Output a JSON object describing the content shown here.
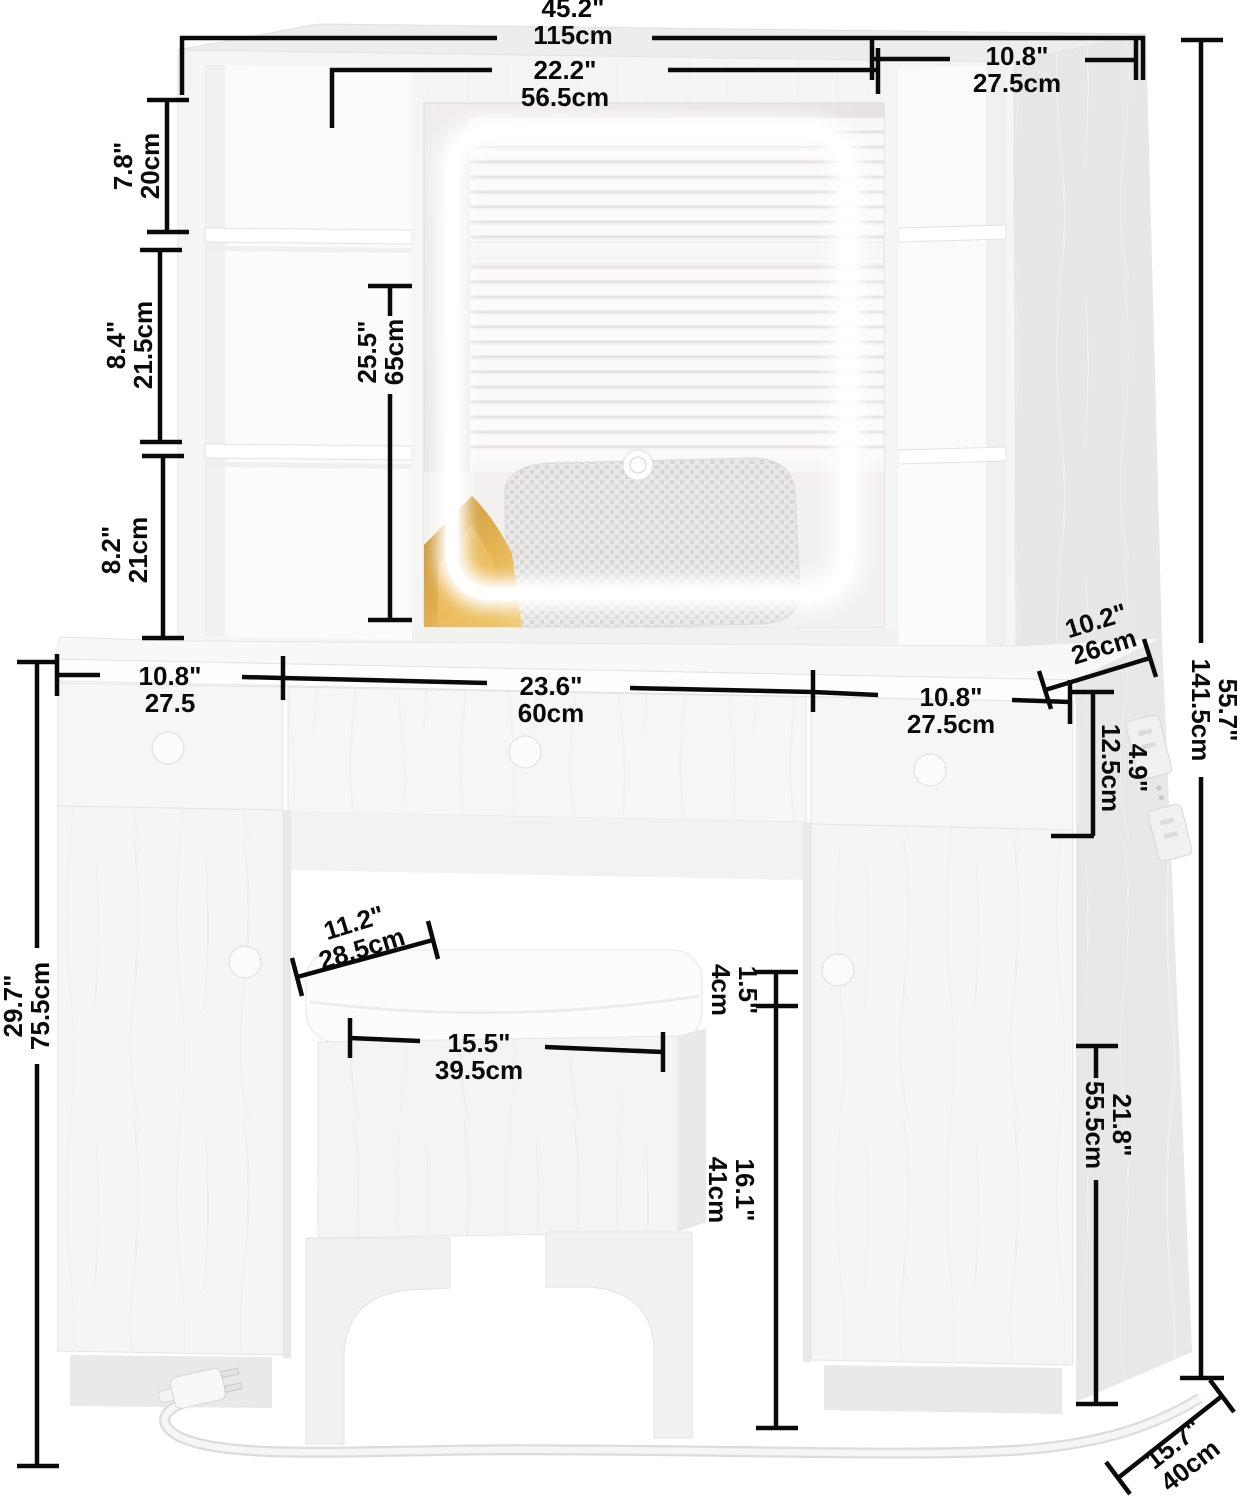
{
  "meta": {
    "type": "furniture-dimension-diagram",
    "subject": "vanity desk with LED mirror hutch and storage stool"
  },
  "colors": {
    "background": "#ffffff",
    "dimension_line": "#0a0a0a",
    "wood_front": "#f6f6f4",
    "wood_side": "#e8e8e6",
    "led_glow": "#ffffff",
    "gold_fabric": "#d9a43e"
  },
  "dimensions": {
    "overall_width": {
      "in": "45.2\"",
      "cm": "115cm"
    },
    "mirror_width": {
      "in": "22.2\"",
      "cm": "56.5cm"
    },
    "right_shelf_width": {
      "in": "10.8\"",
      "cm": "27.5cm"
    },
    "left_shelf_top": {
      "in": "7.8\"",
      "cm": "20cm"
    },
    "left_shelf_mid": {
      "in": "8.4\"",
      "cm": "21.5cm"
    },
    "left_shelf_bottom": {
      "in": "8.2\"",
      "cm": "21cm"
    },
    "mirror_height": {
      "in": "25.5\"",
      "cm": "65cm"
    },
    "hutch_depth": {
      "in": "10.2\"",
      "cm": "26cm"
    },
    "total_height": {
      "in": "55.7\"",
      "cm": "141.5cm"
    },
    "left_drawer_width": {
      "in": "10.8\"",
      "cm": "27.5"
    },
    "middle_drawer_width": {
      "in": "23.6\"",
      "cm": "60cm"
    },
    "right_drawer_width": {
      "in": "10.8\"",
      "cm": "27.5cm"
    },
    "drawer_height": {
      "in": "4.9\"",
      "cm": "12.5cm"
    },
    "desk_height": {
      "in": "29.7\"",
      "cm": "75.5cm"
    },
    "stool_depth": {
      "in": "11.2\"",
      "cm": "28.5cm"
    },
    "stool_width": {
      "in": "15.5\"",
      "cm": "39.5cm"
    },
    "cushion_height": {
      "in": "1.5\"",
      "cm": "4cm"
    },
    "stool_leg_height": {
      "in": "16.1\"",
      "cm": "41cm"
    },
    "cabinet_height": {
      "in": "21.8\"",
      "cm": "55.5cm"
    },
    "base_depth": {
      "in": "15.7\"",
      "cm": "40cm"
    }
  }
}
